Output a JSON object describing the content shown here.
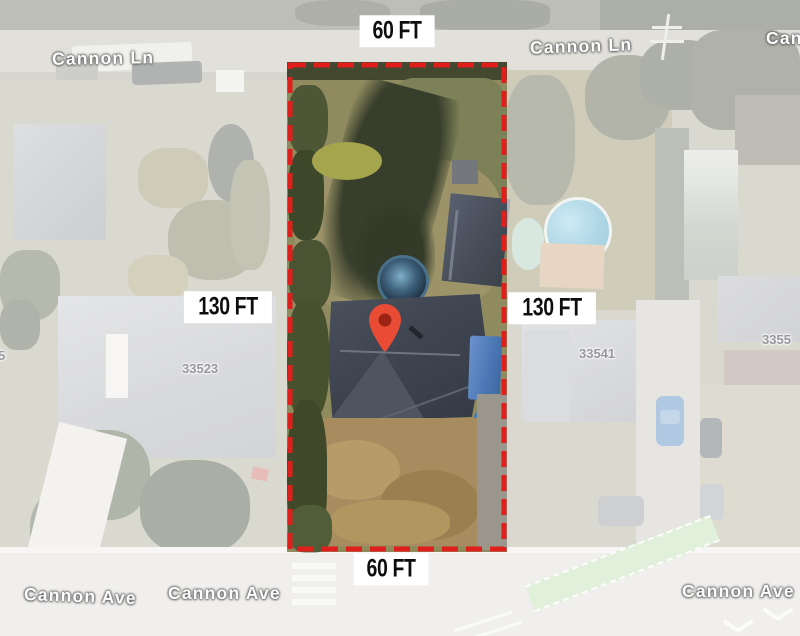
{
  "annotations": {
    "dimension_top": "60 FT",
    "dimension_bottom": "60 FT",
    "dimension_left": "130 FT",
    "dimension_right": "130 FT"
  },
  "streets": {
    "cannon_ln_left": "Cannon Ln",
    "cannon_ln_center": "Cannon Ln",
    "cannon_ln_far_right": "Cann",
    "cannon_ave_left_a": "Cannon Ave",
    "cannon_ave_left_b": "Cannon Ave",
    "cannon_ave_right": "Cannon Ave"
  },
  "parcel_numbers": {
    "left_edge_partial": "5",
    "left_house": "33523",
    "right_house": "33541",
    "right_edge_partial": "3355"
  },
  "colors": {
    "boundary": "#e01f1c",
    "pin_fill": "#ea4b35",
    "pin_core": "#9b2413",
    "label_bg": "#ffffff",
    "label_text": "#0e0e0e",
    "street_label": "#fdfdfd",
    "parcel_label": "#97979d"
  }
}
